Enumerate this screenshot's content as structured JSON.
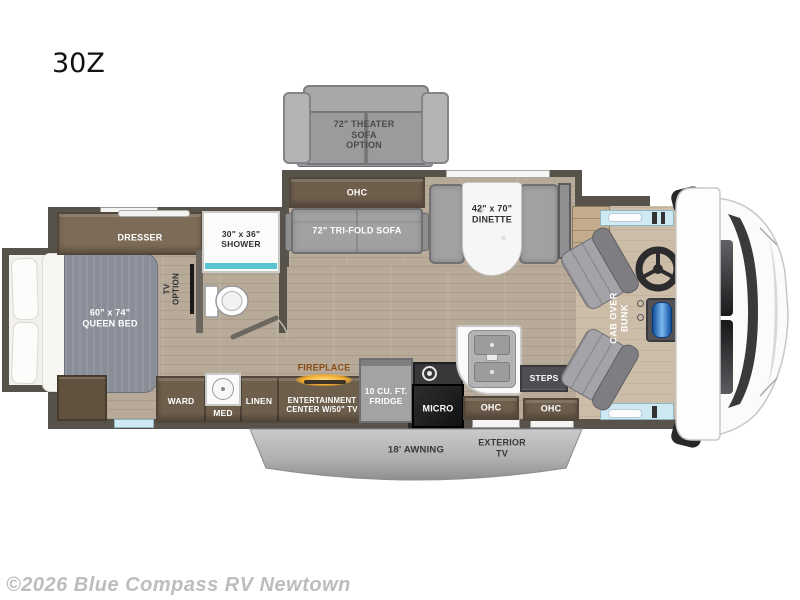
{
  "labels": {
    "model": "30Z",
    "theater_sofa": "72\" THEATER SOFA\nOPTION",
    "ohc_sofa": "OHC",
    "trifold_sofa": "72\" TRI-FOLD SOFA",
    "dinette": "42\" x 70\"\nDINETTE",
    "dresser": "DRESSER",
    "shower": "30\" x 36\"\nSHOWER",
    "queen_bed": "60\" x 74\"\nQUEEN BED",
    "tv_option": "TV\nOPTION",
    "ward": "WARD",
    "med": "MED",
    "linen": "LINEN",
    "fireplace": "FIREPLACE",
    "entertainment_center": "ENTERTAINMENT\nCENTER W/50\" TV",
    "fridge": "10 CU. FT.\nFRIDGE",
    "micro": "MICRO",
    "ohc_kitchen": "OHC",
    "steps": "STEPS",
    "ohc_entry": "OHC",
    "cab_over_bunk": "CAB OVER\nBUNK",
    "awning": "18' AWNING",
    "exterior_tv": "EXTERIOR\nTV",
    "watermark": "©2026 Blue Compass RV Newtown"
  },
  "colors": {
    "wall": "#57524a",
    "floor_wood": "#b7aa99",
    "floor_cab": "#ccbda9",
    "cabinet_brown": "#6e5e4c",
    "upholstery_gray": "#a1a1a3",
    "mattress_gray": "#8a8e98",
    "shower_accent_teal": "#58c4d0",
    "window_blue": "#cfe9f2",
    "fireplace_text": "#8a4a12",
    "fireplace_glow": "#f5c84a",
    "awning_gray": "#b9babc",
    "watermark_gray": "#bdbdbd"
  }
}
